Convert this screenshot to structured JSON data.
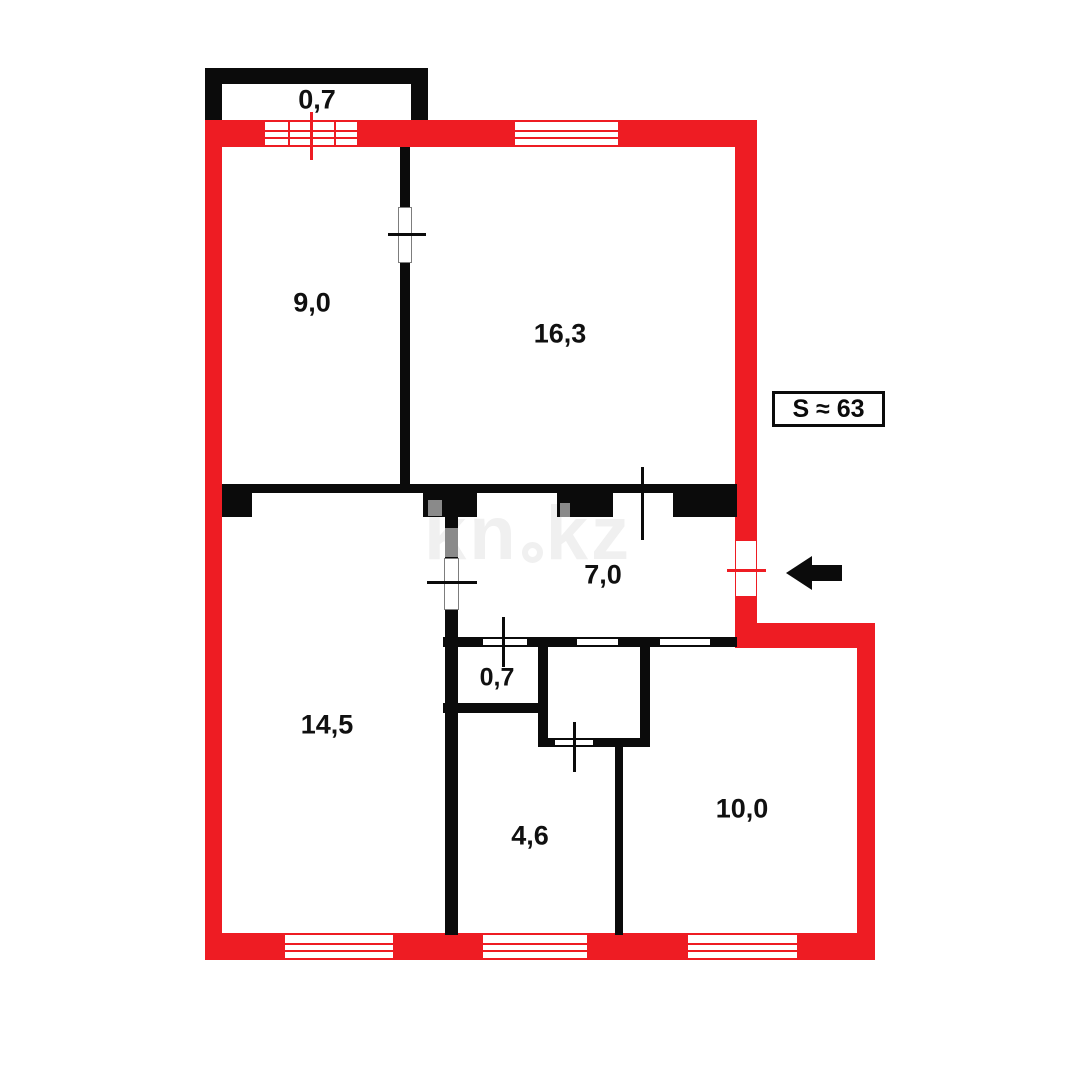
{
  "floorplan": {
    "watermark": {
      "prefix": "kn",
      "suffix": "kz"
    },
    "total_area": {
      "label": "S ≈ 63"
    },
    "rooms": [
      {
        "name": "balcony",
        "area_label": "0,7"
      },
      {
        "name": "room-top-left",
        "area_label": "9,0"
      },
      {
        "name": "room-top-right",
        "area_label": "16,3"
      },
      {
        "name": "hallway",
        "area_label": "7,0"
      },
      {
        "name": "closet",
        "area_label": "0,7"
      },
      {
        "name": "room-bottom-left",
        "area_label": "14,5"
      },
      {
        "name": "room-bottom-middle",
        "area_label": "4,6"
      },
      {
        "name": "room-bottom-right",
        "area_label": "10,0"
      }
    ],
    "icons": {
      "entrance_arrow": "left-arrow",
      "window_symbol": "striped-opening",
      "door_symbol": "white-gap-with-tick"
    },
    "colors": {
      "exterior_wall": "#ee1c23",
      "interior_wall": "#0b0b0b",
      "background": "#ffffff",
      "watermark": "#f0f0f0",
      "shadow_patch": "#8a8a8a"
    }
  }
}
